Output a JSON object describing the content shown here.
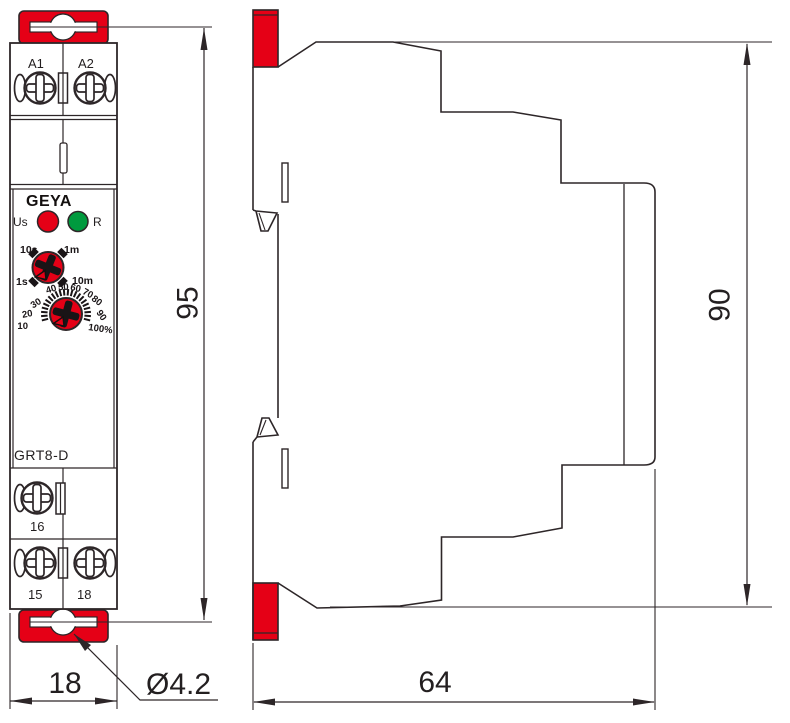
{
  "front_view": {
    "brand": "GEYA",
    "model": "GRT8-D",
    "terminals_top": [
      "A1",
      "A2"
    ],
    "terminal_mid": "16",
    "terminals_bottom": [
      "15",
      "18"
    ],
    "led_supply_label": "Us",
    "led_reset_label": "R",
    "range_dial_labels": [
      "10s",
      "1m",
      "1s",
      "10m"
    ],
    "scale_dial_labels": [
      "10",
      "20",
      "30",
      "40",
      "50",
      "60",
      "70",
      "80",
      "90",
      "100%"
    ]
  },
  "dimensions": {
    "front_height": "95",
    "front_width": "18",
    "mount_hole": "Ø4.2",
    "side_height": "90",
    "side_depth": "64"
  },
  "colors": {
    "accent_red": "#e50016",
    "led_green": "#009a3e",
    "line": "#2d2628"
  }
}
